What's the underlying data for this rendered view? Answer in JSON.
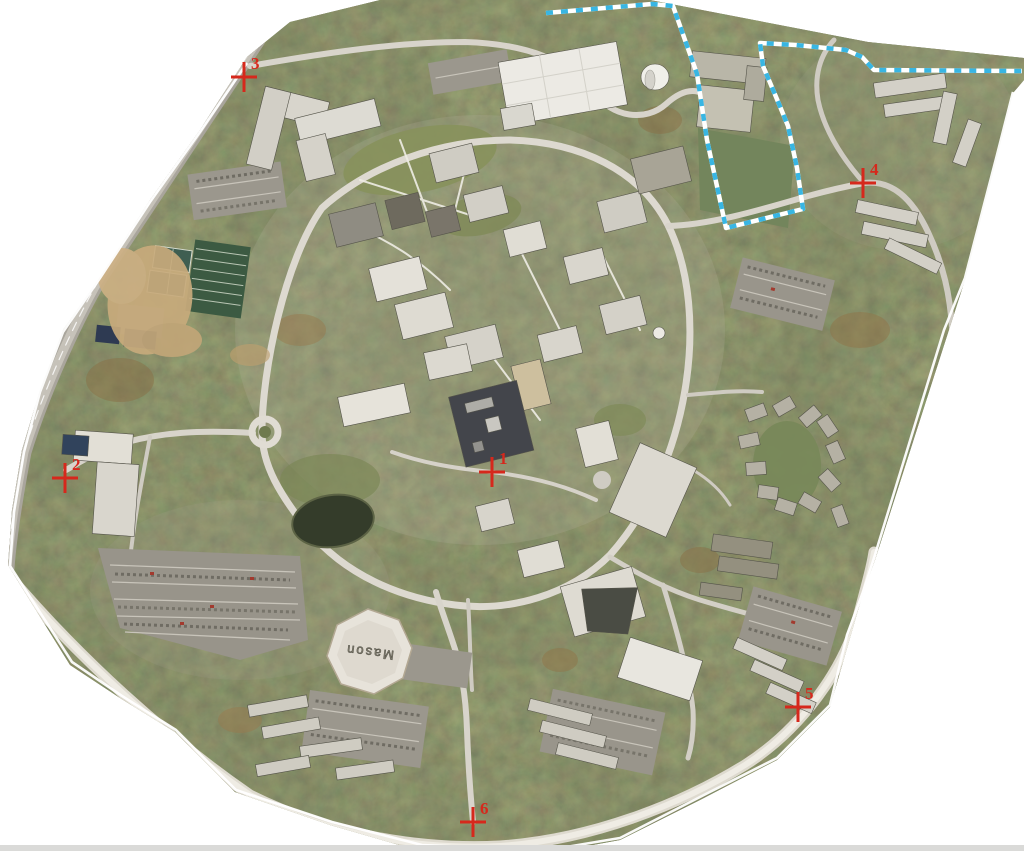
{
  "map": {
    "kind": "aerial-orthophoto-campus",
    "colors": {
      "background": "#ffffff",
      "control_point_red": "#d6281c",
      "parcel_dash_cyan": "#38b6e3",
      "boundary_white": "#ffffff",
      "canopy_green": "#4c502f",
      "road_gray": "#cdc9c0",
      "building_light": "#e6e3da",
      "pond_dark": "#343c2a"
    },
    "markers": [
      {
        "label": "1",
        "x": 492,
        "y": 472
      },
      {
        "label": "2",
        "x": 65,
        "y": 478
      },
      {
        "label": "3",
        "x": 244,
        "y": 77
      },
      {
        "label": "4",
        "x": 863,
        "y": 183
      },
      {
        "label": "5",
        "x": 798,
        "y": 707
      },
      {
        "label": "6",
        "x": 473,
        "y": 822
      }
    ],
    "landmarks": {
      "arena_roof_text": "Mason"
    }
  }
}
